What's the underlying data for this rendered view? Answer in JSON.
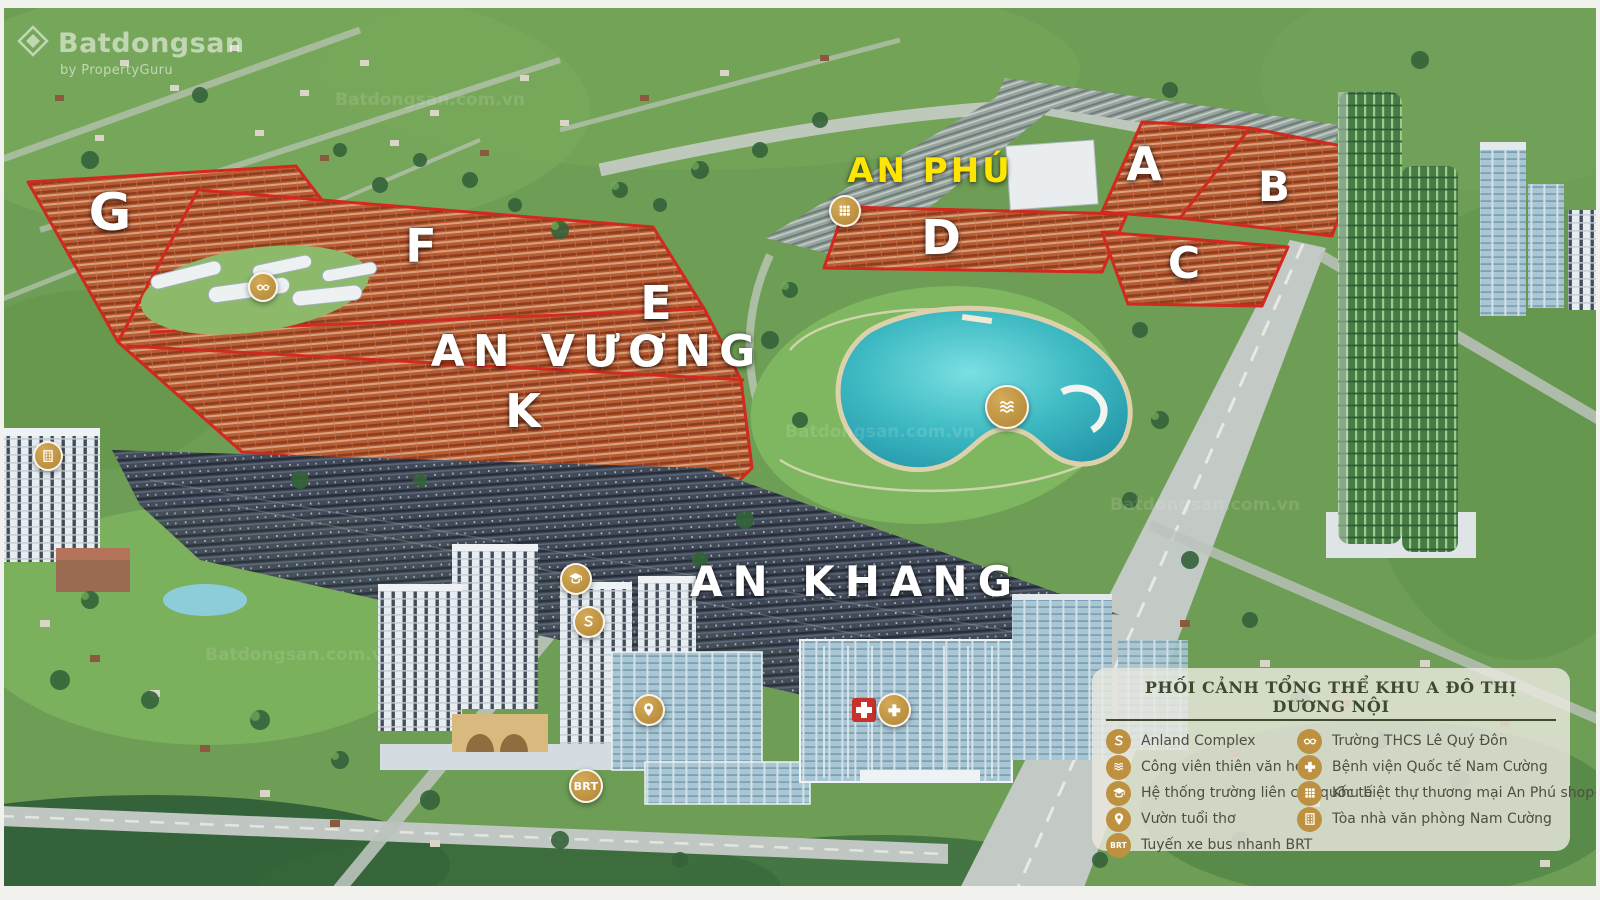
{
  "watermark": {
    "brand": "Batdongsan",
    "byline": "by PropertyGuru",
    "tile": "Batdongsan.com.vn"
  },
  "brt_label": "BRT",
  "areas": [
    {
      "label": "AN PHÚ",
      "x": 930,
      "y": 171,
      "color": "#ffe600",
      "size": 34,
      "spacing": 3
    },
    {
      "label": "AN VƯƠNG",
      "x": 597,
      "y": 352,
      "color": "#ffffff",
      "size": 44,
      "spacing": 8
    },
    {
      "label": "AN KHANG",
      "x": 856,
      "y": 582,
      "color": "#ffffff",
      "size": 42,
      "spacing": 10
    }
  ],
  "zones": [
    {
      "label": "G",
      "x": 110,
      "y": 213,
      "size": 52
    },
    {
      "label": "F",
      "x": 421,
      "y": 246,
      "size": 46
    },
    {
      "label": "E",
      "x": 656,
      "y": 303,
      "size": 46
    },
    {
      "label": "K",
      "x": 523,
      "y": 411,
      "size": 46
    },
    {
      "label": "D",
      "x": 941,
      "y": 238,
      "size": 48
    },
    {
      "label": "A",
      "x": 1144,
      "y": 164,
      "size": 46
    },
    {
      "label": "B",
      "x": 1274,
      "y": 187,
      "size": 42
    },
    {
      "label": "C",
      "x": 1184,
      "y": 264,
      "size": 44
    }
  ],
  "markers": [
    {
      "name": "nam-cuong-office-marker",
      "icon": "office-building-icon",
      "x": 48,
      "y": 456,
      "size": 30
    },
    {
      "name": "le-quy-don-school-marker",
      "icon": "glasses-icon",
      "x": 263,
      "y": 287,
      "size": 30
    },
    {
      "name": "an-phu-shop-villa-marker",
      "icon": "shop-villa-icon",
      "x": 845,
      "y": 211,
      "size": 32
    },
    {
      "name": "astronomy-park-lake-marker",
      "icon": "waves-icon",
      "x": 1007,
      "y": 407,
      "size": 44
    },
    {
      "name": "international-school-marker",
      "icon": "graduation-cap-icon",
      "x": 576,
      "y": 579,
      "size": 32
    },
    {
      "name": "anland-complex-marker",
      "icon": "anland-logo-icon",
      "x": 589,
      "y": 622,
      "size": 32
    },
    {
      "name": "children-garden-marker",
      "icon": "child-pin-icon",
      "x": 649,
      "y": 710,
      "size": 32
    },
    {
      "name": "hospital-marker",
      "icon": "medical-cross-icon",
      "x": 894,
      "y": 710,
      "size": 34
    },
    {
      "name": "brt-marker",
      "icon": "brt-icon",
      "x": 586,
      "y": 786,
      "size": 34
    }
  ],
  "legend": {
    "title": "PHỐI CẢNH TỔNG THỂ KHU A ĐÔ THỊ DƯƠNG NỘI",
    "left": [
      {
        "icon": "anland-logo-icon",
        "label": "Anland Complex"
      },
      {
        "icon": "waves-icon",
        "label": "Công viên thiên văn học"
      },
      {
        "icon": "graduation-cap-icon",
        "label": "Hệ thống trường liên cấp quốc tế"
      },
      {
        "icon": "child-pin-icon",
        "label": "Vườn tuổi thơ"
      },
      {
        "icon": "brt-icon",
        "label": "Tuyến xe bus nhanh BRT"
      }
    ],
    "right": [
      {
        "icon": "glasses-icon",
        "label": "Trường THCS Lê Quý Đôn"
      },
      {
        "icon": "medical-cross-icon",
        "label": "Bệnh viện Quốc tế Nam Cường"
      },
      {
        "icon": "shop-villa-icon",
        "label": "Khu biệt thự thương mại An Phú shop-villa"
      },
      {
        "icon": "office-building-icon",
        "label": "Tòa nhà văn phòng Nam Cường"
      }
    ]
  },
  "colors": {
    "boundary_red": "#d2281e",
    "marker_gold": "#bd9140",
    "an_phu_yellow": "#ffe600",
    "lake_teal": "#3db9c2",
    "legend_bg": "rgba(234,233,224,0.82)",
    "legend_title_text": "#3d4a2e",
    "legend_item_text": "#4c4f40"
  }
}
